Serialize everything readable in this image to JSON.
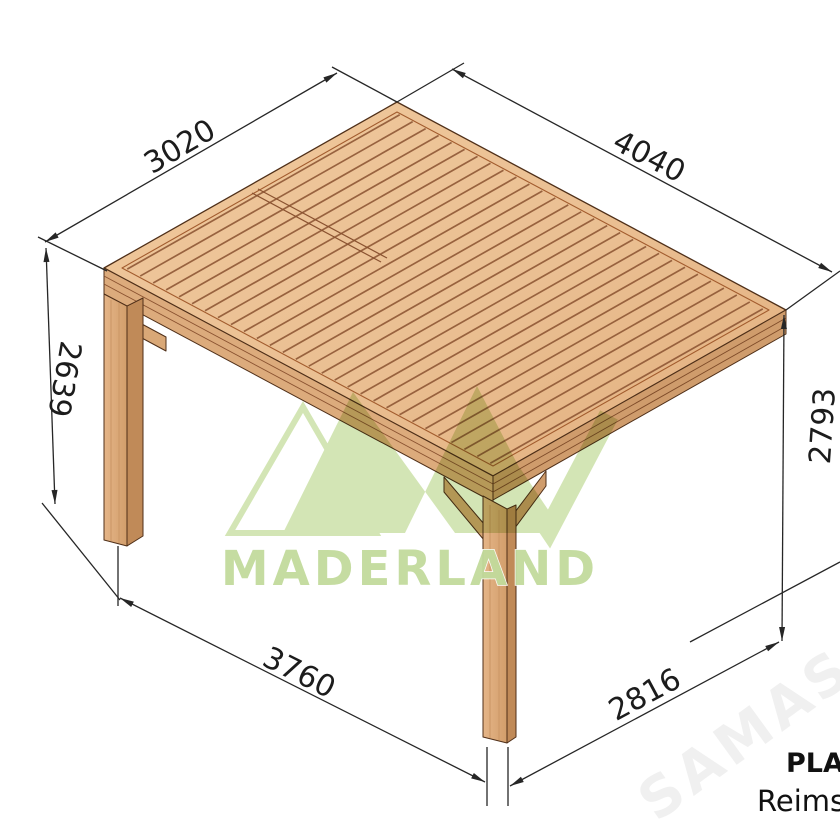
{
  "drawing": {
    "type": "isometric technical drawing of wall-mounted wooden pergola",
    "dimensions": {
      "roof_depth": "3020",
      "roof_width": "4040",
      "post_height": "2639",
      "wall_height": "2793",
      "post_spacing": "3760",
      "post_to_wall_depth": "2816"
    },
    "colors": {
      "wood": "#eabf92",
      "wood_dark": "#cf9c6c",
      "gap_line": "#8a5230",
      "line": "#262626"
    }
  },
  "brand": {
    "logo_text": "MADERLAND",
    "logo_green": "#cfe3ad"
  },
  "product": {
    "name_bold": "PLA",
    "name_sub": "Reims"
  },
  "watermark": {
    "text": "SAMAS"
  }
}
